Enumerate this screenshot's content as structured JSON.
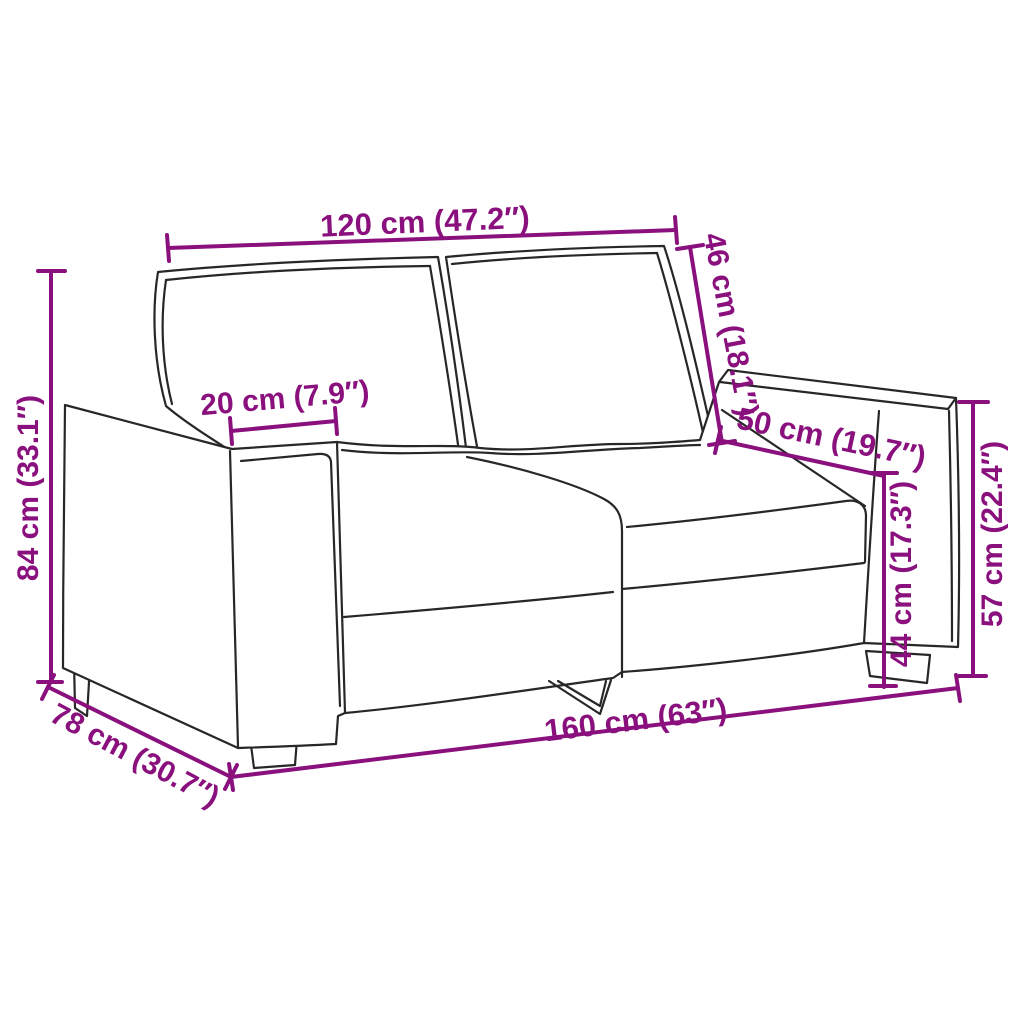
{
  "diagram": {
    "type": "product dimension diagram",
    "subject": "2-seater sofa line drawing",
    "accent_color": "#8A107E",
    "outline_color": "#272727",
    "background_color": "#FFFFFF",
    "units": "cm / inches",
    "dimensions": {
      "back_width": {
        "label": "120 cm (47.2″)"
      },
      "armrest_width": {
        "label": "20 cm (7.9″)"
      },
      "backrest_height": {
        "label": "46 cm (18.1″)"
      },
      "seat_depth": {
        "label": "50 cm (19.7″)"
      },
      "seat_height": {
        "label": "44 cm (17.3″)"
      },
      "armrest_height": {
        "label": "57 cm (22.4″)"
      },
      "overall_height": {
        "label": "84 cm (33.1″)"
      },
      "overall_depth": {
        "label": "78 cm (30.7″)"
      },
      "overall_width": {
        "label": "160 cm (63″)"
      }
    }
  }
}
